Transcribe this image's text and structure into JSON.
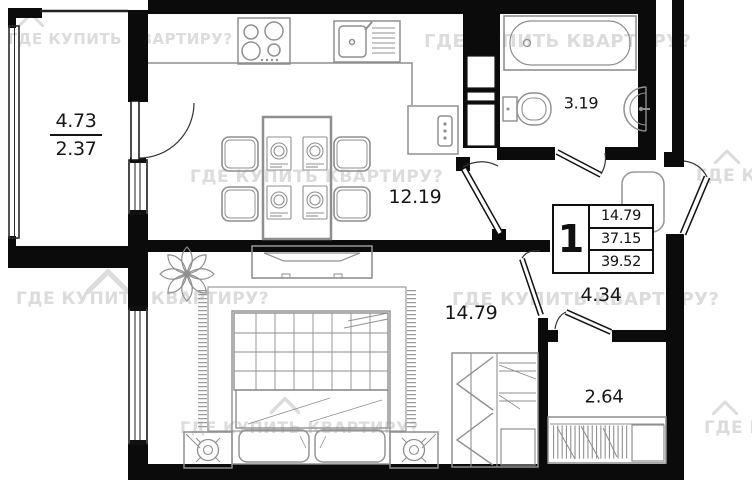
{
  "watermark": {
    "text": "ГДЕ КУПИТЬ КВАРТИРУ?"
  },
  "info_box": {
    "rooms_count": "1",
    "rows": [
      "14.79",
      "37.15",
      "39.52"
    ]
  },
  "areas": {
    "balcony_full": "4.73",
    "balcony_reduced": "2.37",
    "kitchen_living": "12.19",
    "bathroom": "3.19",
    "bedroom": "14.79",
    "hallway": "4.34",
    "closet": "2.64"
  },
  "colors": {
    "wall": "#0b0b0b",
    "furniture": "#8f8f8f",
    "label": "#161616",
    "watermark": "#dcdcdc"
  }
}
